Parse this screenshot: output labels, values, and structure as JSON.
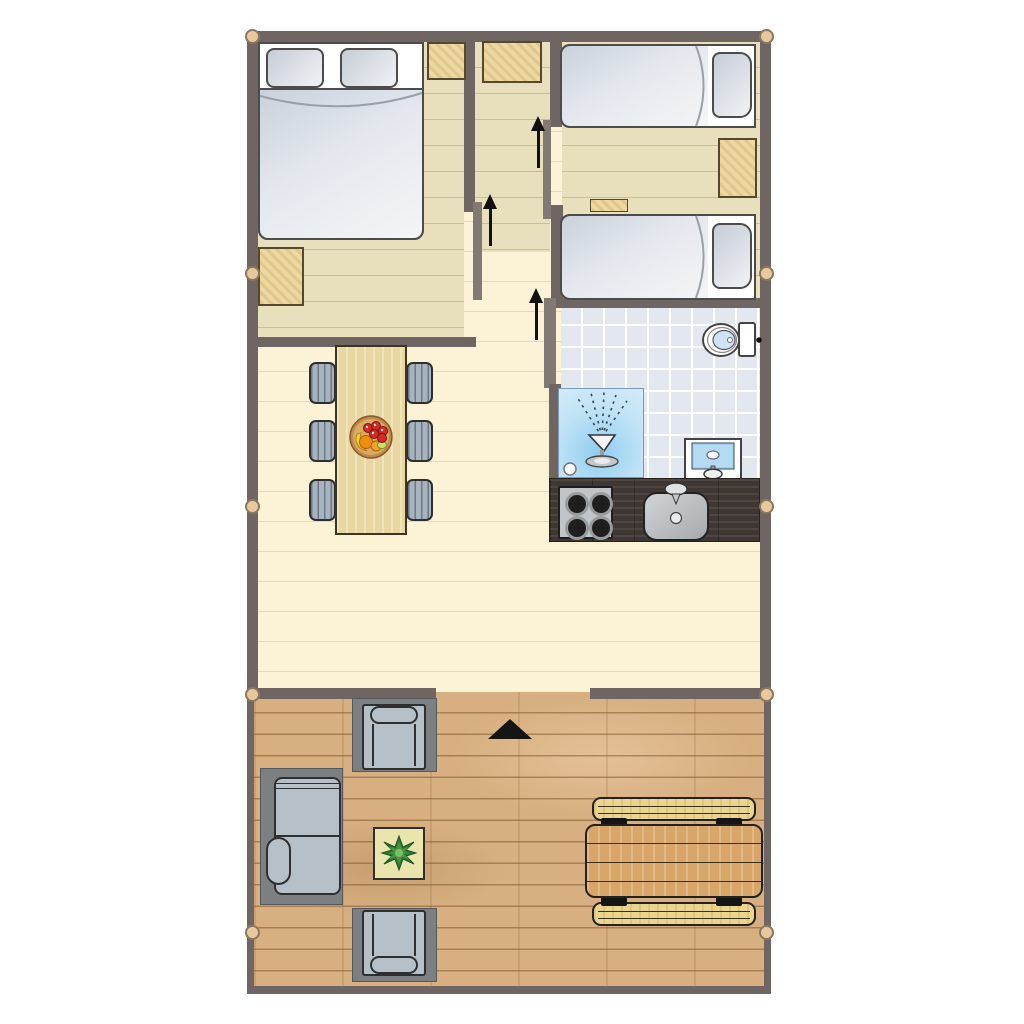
{
  "title": "glamping-lodge-floor-plan",
  "palette": {
    "wall": "#6f6663",
    "door_panel": "#827975",
    "peg_fill": "#eac89d",
    "indoor_floor": "#fcf3d6",
    "bedroom_floor": "#e8e0bd",
    "bathroom_tile": "#e3e7ef",
    "deck_wood": "#d7af80",
    "cabinet_wood": "#ecd8a0",
    "bed_linen": "#e4e8ee",
    "kitchen_counter": "#3e3733",
    "shower_blue": "#8fcdf1",
    "chair_gray": "#a7b3bf",
    "picnic_wood": "#d8a668",
    "plant_green": "#2e7b33",
    "arrow_black": "#111111"
  },
  "rooms": [
    {
      "id": "master-bedroom",
      "furniture": [
        "double-bed",
        "two-pillows",
        "cabinet",
        "nightstand"
      ]
    },
    {
      "id": "hallway",
      "furniture": [
        "cabinet"
      ],
      "entrance_arrows": 3
    },
    {
      "id": "twin-bedroom",
      "furniture": [
        "single-bed",
        "single-bed",
        "dresser",
        "shelf"
      ]
    },
    {
      "id": "bathroom",
      "furniture": [
        "shower",
        "toilet",
        "washbasin"
      ]
    },
    {
      "id": "kitchen",
      "furniture": [
        "counter",
        "stove-4-burners",
        "sink-with-faucet"
      ]
    },
    {
      "id": "living-dining",
      "furniture": [
        "dining-table",
        "fruit-bowl"
      ],
      "chairs": 6
    },
    {
      "id": "deck",
      "furniture": [
        "sofa",
        "armchair",
        "armchair",
        "plant-table",
        "picnic-table",
        "bench",
        "bench"
      ],
      "entrance_marker": "black-triangle"
    }
  ],
  "markers": {
    "wall_pegs": 10,
    "direction_arrows": 3,
    "entrance_triangle": 1
  }
}
